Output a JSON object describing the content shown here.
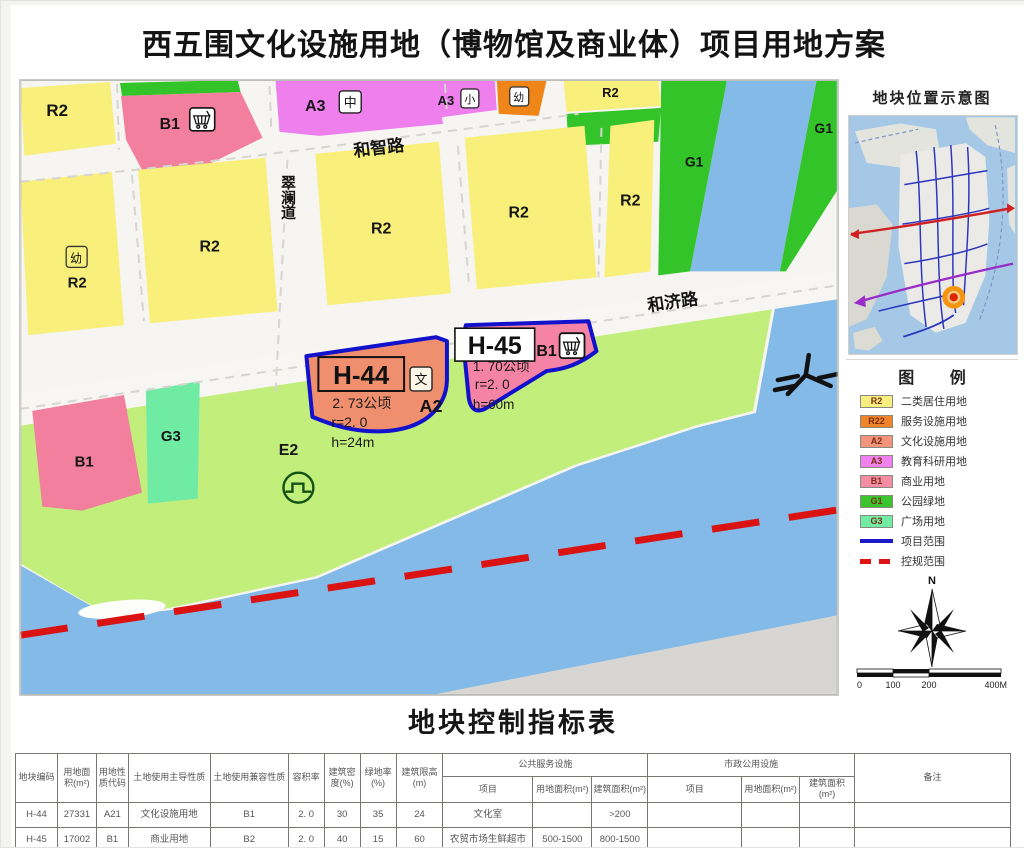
{
  "title": "西五围文化设施用地（博物馆及商业体）项目用地方案",
  "map": {
    "roads": {
      "hezhi": "和智路",
      "cuilan": "翠澜道",
      "heji": "和济路"
    },
    "zones": {
      "r2_top_left": "R2",
      "b1_top": "B1",
      "a3_mid": "A3",
      "a3_small": "A3",
      "r2_top": "R2",
      "g1_band": "G1",
      "g1_right": "G1",
      "r2_row_a": "R2",
      "r2_row_b": "R2",
      "r2_row_c": "R2",
      "r2_row_d": "R2",
      "r2_row_e": "R2",
      "b1_low": "B1",
      "g3": "G3",
      "e2": "E2"
    },
    "badges": {
      "zhong": "中",
      "xiao": "小",
      "you_top": "幼",
      "you_left": "幼",
      "wen": "文"
    },
    "plots": {
      "h44": {
        "id": "H-44",
        "area": "2. 73公顷",
        "code": "A2",
        "far": "r=2. 0",
        "height": "h=24m"
      },
      "h45": {
        "id": "H-45",
        "code": "B1",
        "area": "1. 70公顷",
        "far": "r=2. 0",
        "height": "h=60m"
      }
    },
    "boundary_colors": {
      "project": "#1212cc",
      "control": "#db1212"
    }
  },
  "sidebar": {
    "location_title": "地块位置示意图",
    "legend_title": "图        例",
    "legend": [
      {
        "code": "R2",
        "label": "二类居住用地",
        "color": "#f6ee7e"
      },
      {
        "code": "R22",
        "label": "服务设施用地",
        "color": "#f08428"
      },
      {
        "code": "A2",
        "label": "文化设施用地",
        "color": "#f2947c"
      },
      {
        "code": "A3",
        "label": "教育科研用地",
        "color": "#ef82ee"
      },
      {
        "code": "B1",
        "label": "商业用地",
        "color": "#f48ca4"
      },
      {
        "code": "G1",
        "label": "公园绿地",
        "color": "#3ac52e"
      },
      {
        "code": "G3",
        "label": "广场用地",
        "color": "#72eba4"
      },
      {
        "code": "",
        "label": "项目范围",
        "color": "#1a1ac8",
        "style": "solid"
      },
      {
        "code": "",
        "label": "控规范围",
        "color": "#dd1414",
        "style": "dashed"
      }
    ],
    "north_label": "N",
    "scale_ticks": [
      "0",
      "100",
      "200",
      "400M"
    ]
  },
  "table": {
    "title": "地块控制指标表",
    "headers": {
      "plot_code": "地块编码",
      "land_area": "用地面积(m²)",
      "nature_code": "用地性质代码",
      "primary_use": "土地使用主导性质",
      "compatible_use": "土地使用兼容性质",
      "far": "容积率",
      "density": "建筑密度(%)",
      "green_rate": "绿地率(%)",
      "height_limit": "建筑限高(m)",
      "public_group": "公共服务设施",
      "municipal_group": "市政公用设施",
      "item": "项目",
      "facility_land_area": "用地面积(m²)",
      "facility_floor_area": "建筑面积(m²)",
      "remark": "备注"
    },
    "rows": [
      {
        "plot_code": "H-44",
        "land_area": "27331",
        "nature_code": "A21",
        "primary_use": "文化设施用地",
        "compatible_use": "B1",
        "far": "2. 0",
        "density": "30",
        "green_rate": "35",
        "height_limit": "24",
        "ps_item": "文化室",
        "ps_land": "",
        "ps_floor": ">200",
        "mu_item": "",
        "mu_land": "",
        "mu_floor": "",
        "remark": ""
      },
      {
        "plot_code": "H-45",
        "land_area": "17002",
        "nature_code": "B1",
        "primary_use": "商业用地",
        "compatible_use": "B2",
        "far": "2. 0",
        "density": "40",
        "green_rate": "15",
        "height_limit": "60",
        "ps_item": "农贸市场生鲜超市",
        "ps_land": "500-1500",
        "ps_floor": "800-1500",
        "mu_item": "",
        "mu_land": "",
        "mu_floor": "",
        "remark": ""
      }
    ]
  }
}
